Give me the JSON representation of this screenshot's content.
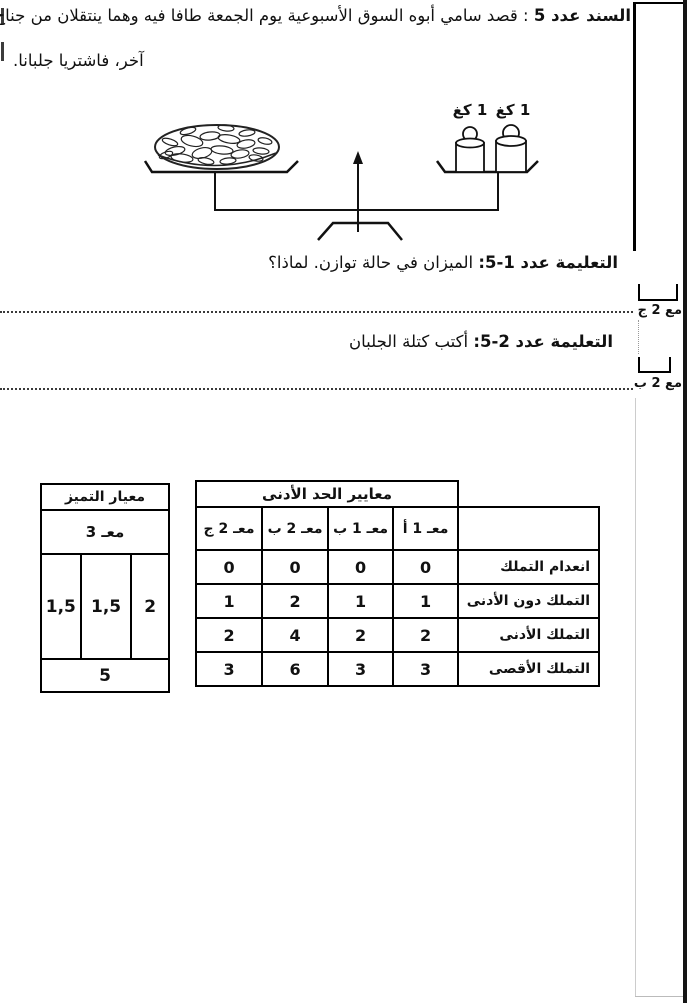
{
  "document": {
    "source_label": "السند عدد 5",
    "source_sep": " : ",
    "source_text_line1": "قصد سامي أبوه السوق الأسبوعية يوم الجمعة طافا فيه وهما ينتقلان من جناح إلى",
    "source_text_line2": "آخر، فاشتريا جلبانا."
  },
  "figure": {
    "weight_labels": [
      "1 كغ",
      "1 كغ"
    ]
  },
  "instructions": [
    {
      "label": "التعليمة عدد 1-5:",
      "text": " الميزان في حالة توازن. لماذا؟"
    },
    {
      "label": "التعليمة عدد 2-5:",
      "text": " أكتب كتلة الجلبان"
    }
  ],
  "margin_marks": [
    {
      "label": "مع 2 ج"
    },
    {
      "label": "مع 2 ب"
    }
  ],
  "excellence_table": {
    "title": "معيار التميز",
    "criterion_label": "معـ 3",
    "values": [
      "2",
      "1,5",
      "1,5"
    ],
    "total": "5"
  },
  "minimum_table": {
    "title": "معايير الحد الأدنى",
    "columns": [
      "معـ 1 أ",
      "معـ 1 ب",
      "معـ 2 ب",
      "معـ 2 ج"
    ],
    "rows": [
      {
        "label": "انعدام التملك",
        "values": [
          "0",
          "0",
          "0",
          "0"
        ]
      },
      {
        "label": "التملك دون الأدنى",
        "values": [
          "1",
          "1",
          "2",
          "1"
        ]
      },
      {
        "label": "التملك الأدنى",
        "values": [
          "2",
          "2",
          "4",
          "2"
        ]
      },
      {
        "label": "التملك الأقصى",
        "values": [
          "3",
          "3",
          "6",
          "3"
        ]
      }
    ]
  }
}
